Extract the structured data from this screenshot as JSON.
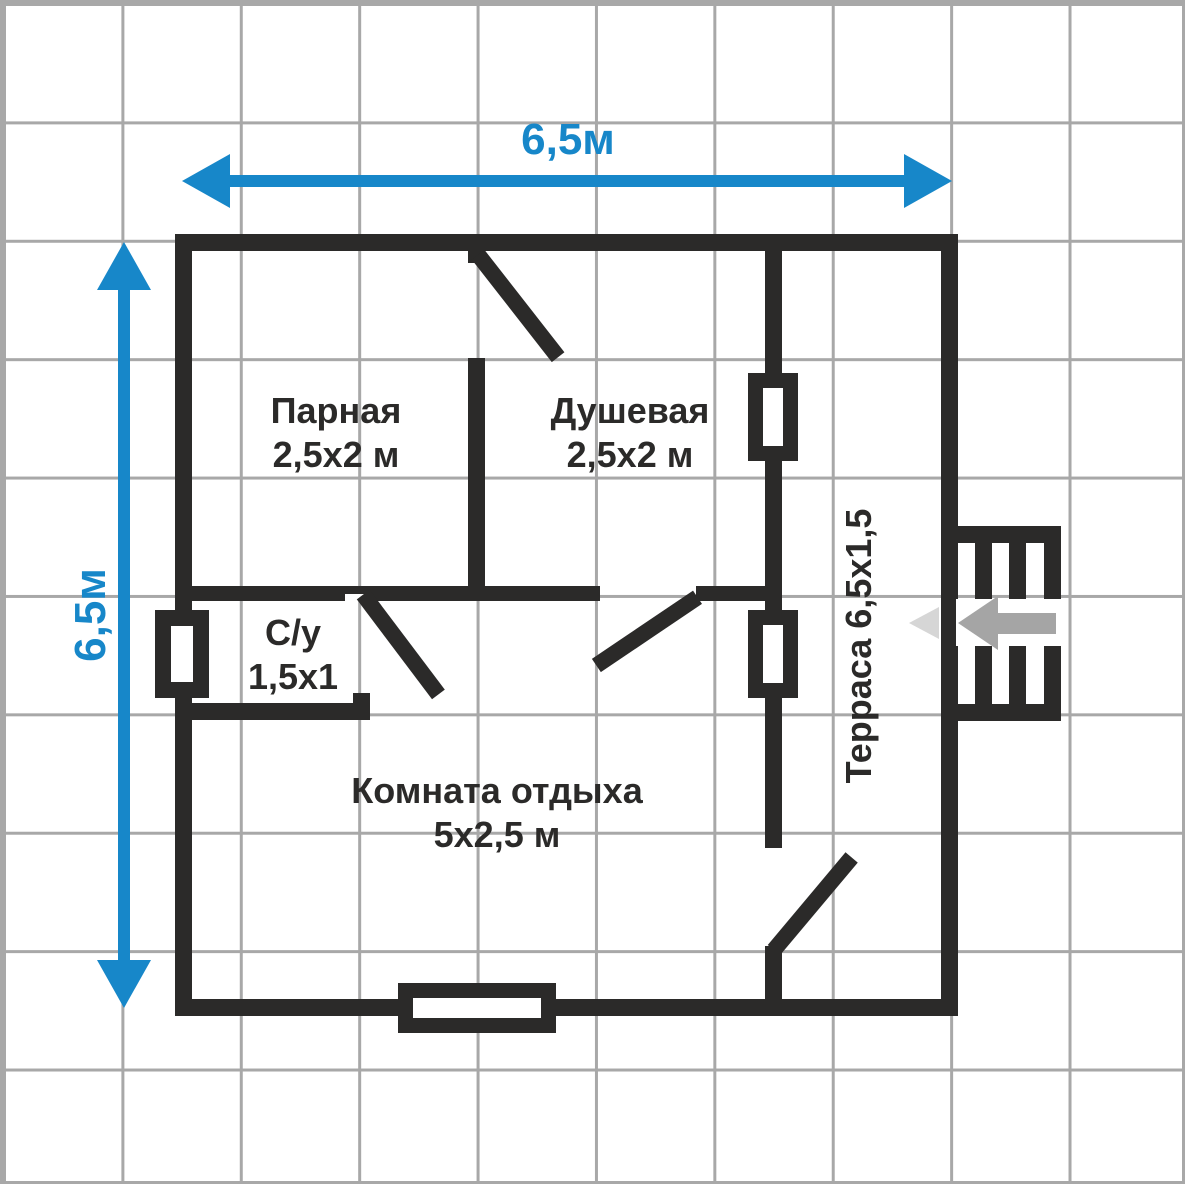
{
  "title": "План бани 6,5x6,5",
  "colors": {
    "wall": "#2b2a29",
    "grid": "#a8a8a8",
    "blue": "#1787c9",
    "arrow_gray": "#a5a5a5",
    "arrow_gray_faint": "#d6d6d6",
    "bg": "#ffffff"
  },
  "dimensions": {
    "top": "6,5м",
    "left": "6,5м"
  },
  "rooms": {
    "parnaya": {
      "name": "Парная",
      "size": "2,5х2 м"
    },
    "dushevaya": {
      "name": "Душевая",
      "size": "2,5х2 м"
    },
    "su": {
      "name": "С/у",
      "size": "1,5х1"
    },
    "komnata": {
      "name": "Комната отдыха",
      "size": "5х2,5 м"
    },
    "terrasa": {
      "label": "Терраса 6,5х1,5"
    }
  },
  "symbols": {
    "stairs": "entrance-stairs",
    "entrance_arrow": "entrance-direction-arrow",
    "windows": "window-symbol",
    "doors": "door-leaf-symbol"
  }
}
